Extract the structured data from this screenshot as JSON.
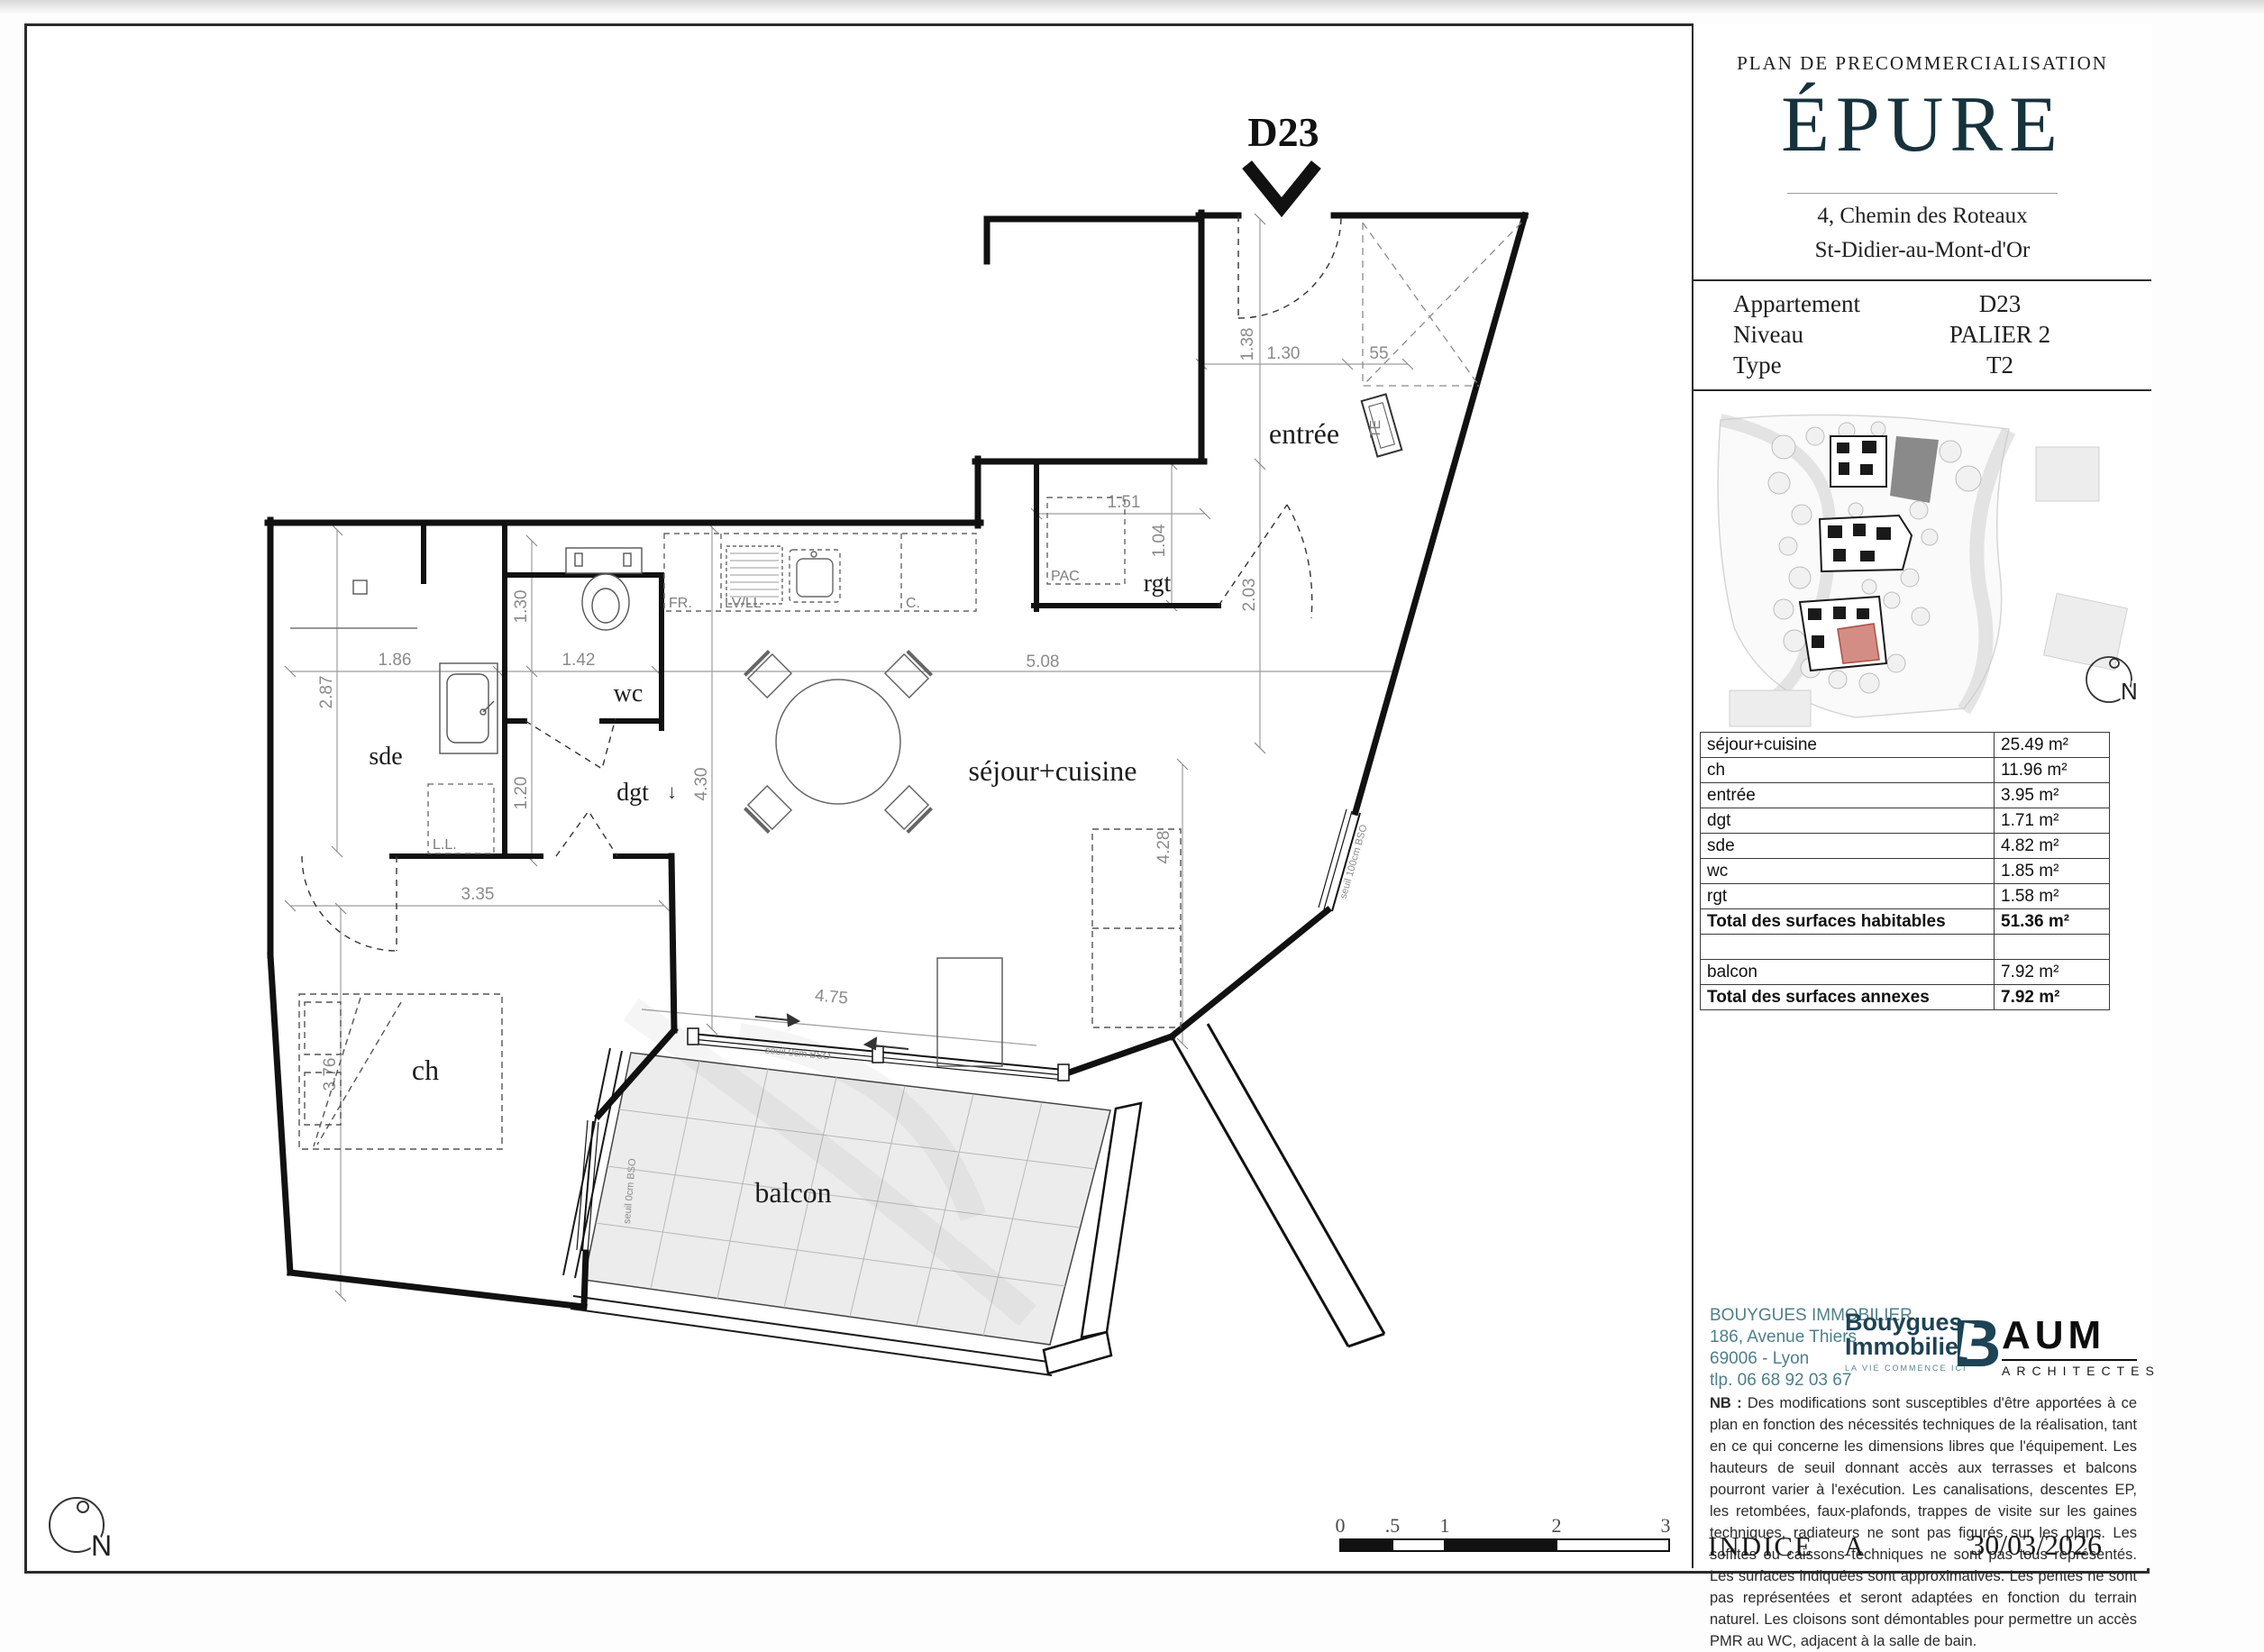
{
  "colors": {
    "brand": "#16323c",
    "contact_teal": "#4e7f8a",
    "logo_navy": "#1d4355",
    "highlight_red": "#c75f52",
    "wall_black": "#111111",
    "dim_gray": "#8b8b8b",
    "balcony_fill": "#ececec"
  },
  "header": {
    "plan_type": "PLAN DE PRECOMMERCIALISATION",
    "project": "ÉPURE",
    "address_line1": "4, Chemin des Roteaux",
    "address_line2": "St-Didier-au-Mont-d'Or"
  },
  "info": {
    "rows": [
      {
        "label": "Appartement",
        "value": "D23"
      },
      {
        "label": "Niveau",
        "value": "PALIER 2"
      },
      {
        "label": "Type",
        "value": "T2"
      }
    ]
  },
  "surfaces": {
    "rows": [
      {
        "label": "séjour+cuisine",
        "value": "25.49 m²"
      },
      {
        "label": "ch",
        "value": "11.96 m²"
      },
      {
        "label": "entrée",
        "value": "3.95 m²"
      },
      {
        "label": "dgt",
        "value": "1.71 m²"
      },
      {
        "label": "sde",
        "value": "4.82 m²"
      },
      {
        "label": "wc",
        "value": "1.85 m²"
      },
      {
        "label": "rgt",
        "value": "1.58 m²"
      },
      {
        "label": "Total des surfaces habitables",
        "value": "51.36 m²"
      },
      {
        "label": "",
        "value": ""
      },
      {
        "label": "balcon",
        "value": "7.92 m²"
      },
      {
        "label": "Total des surfaces annexes",
        "value": "7.92 m²"
      }
    ]
  },
  "plan": {
    "unit": "D23",
    "rooms": {
      "sejour": "séjour+cuisine",
      "ch": "ch",
      "entree": "entrée",
      "dgt": "dgt",
      "sde": "sde",
      "wc": "wc",
      "rgt": "rgt",
      "balcon": "balcon"
    },
    "dims": {
      "entree_height": "1.38",
      "entree_width": "1.30",
      "shaft_width": "55",
      "entree_length": "2.03",
      "rgt_width": "1.51",
      "rgt_depth": "1.04",
      "sde_width": "1.86",
      "sde_depth": "2.87",
      "wc_width": "1.42",
      "wc_depth": "1.30",
      "dgt_depth": "1.20",
      "sejour_width": "5.08",
      "sejour_depth": "4.30",
      "ch_width": "3.35",
      "ch_depth": "3.76",
      "sejour_side": "4.28",
      "terrace_top": "4.75",
      "balcon_width": "4.10",
      "balcon_depth": "1.87"
    },
    "annotations": {
      "pac": "PAC",
      "fridge": "FR.",
      "dishwasher": "LV/LL",
      "cooker": "C.",
      "electrical": "TE",
      "washer": "L.L.",
      "seuil_balcon": "seuil 0cm BSO",
      "seuil_window": "seuil 100cm BSO",
      "arrow_down": "↓"
    },
    "scale": {
      "labels": [
        "0",
        ".5",
        "1",
        "2",
        "3"
      ]
    },
    "compass": "N"
  },
  "site": {
    "north": "N"
  },
  "contact": {
    "lines": [
      "BOUYGUES IMMOBILIER",
      "186, Avenue Thiers",
      "69006 - Lyon",
      "tlp.  06 68 92 03 67"
    ]
  },
  "logos": {
    "bouygues": {
      "line1": "Bouygues",
      "line2": "Immobilier",
      "tagline": "LA VIE COMMENCE ICI",
      "mark": "B"
    },
    "aum": {
      "name": "AUM",
      "sub": "ARCHITECTES"
    }
  },
  "note": {
    "label": "NB :",
    "text": " Des modifications sont susceptibles d'être apportées à ce plan en fonction des nécessités techniques de la réalisation, tant en ce qui concerne les dimensions libres que l'équipement. Les hauteurs de seuil donnant accès aux terrasses et balcons pourront varier à l'exécution. Les canalisations, descentes EP, les retombées, faux-plafonds, trappes de visite sur les gaines techniques, radiateurs ne sont pas figurés sur les plans. Les soffites ou caissons techniques ne sont pas tous représentés. Les surfaces indiquées sont approximatives. Les pentes ne sont pas représentées et seront adaptées en fonction du terrain naturel. Les cloisons sont démontables pour permettre un accès PMR au WC, adjacent à la salle de bain."
  },
  "footer": {
    "indice_label": "INDICE",
    "indice_value": "A",
    "date": "30/03/2026"
  }
}
